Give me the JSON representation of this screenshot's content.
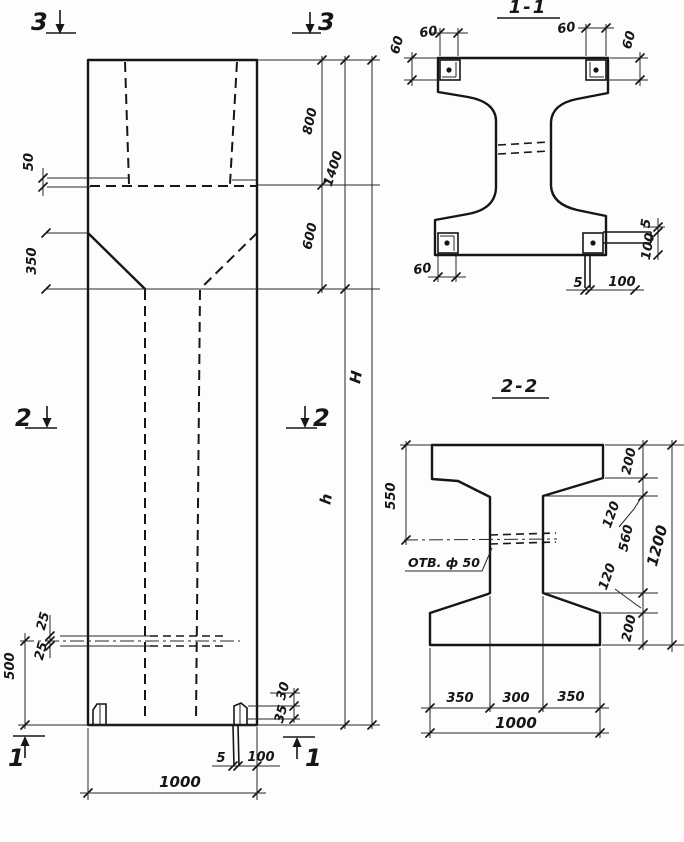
{
  "elevation": {
    "marks": {
      "s3_left": "3",
      "s3_right": "3",
      "s2_left": "2",
      "s2_right": "2",
      "s1_left": "1",
      "s1_right": "1"
    },
    "dims": {
      "ledge_50": "50",
      "taper_350": "350",
      "top_800": "800",
      "top_600": "600",
      "top_1400": "1400",
      "total_H": "H",
      "shaft_h": "h",
      "hole_25a": "25",
      "hole_25b": "25",
      "base_500": "500",
      "foot_30": "30",
      "foot_35": "35",
      "leg_5": "5",
      "leg_100": "100",
      "width_1000": "1000"
    }
  },
  "section1": {
    "title": "1-1",
    "dims": {
      "tl_60": "60",
      "left_60": "60",
      "tr_60": "60",
      "right_60": "60",
      "bl_60": "60",
      "bottom_5": "5",
      "bottom_100": "100",
      "rside_5": "5",
      "rside_100": "100"
    }
  },
  "section2": {
    "title": "2-2",
    "hole_label": "ОТВ. ф 50",
    "dims": {
      "left_550": "550",
      "top_200": "200",
      "top_120": "120",
      "mid_560": "560",
      "bot_120": "120",
      "bot_200": "200",
      "right_1200": "1200",
      "bl_350": "350",
      "bm_300": "300",
      "br_350": "350",
      "bw_1000": "1000"
    }
  }
}
